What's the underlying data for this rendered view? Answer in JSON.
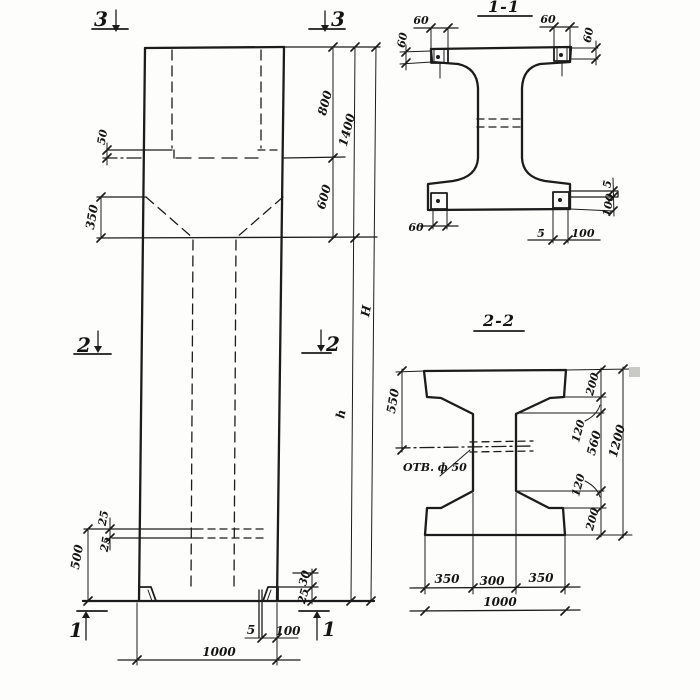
{
  "markers": {
    "section3": "3",
    "section2": "2",
    "section1": "1"
  },
  "elevation": {
    "dim_50": "50",
    "dim_350": "350",
    "dim_800": "800",
    "dim_1400": "1400",
    "dim_600": "600",
    "dim_H": "H",
    "dim_h": "h",
    "dim_25_top": "25",
    "dim_25_bottom": "25",
    "dim_500": "500",
    "dim_30_foot": "30",
    "dim_25_foot": "25",
    "dim_5_base": "5",
    "dim_100_base": "100",
    "dim_1000": "1000"
  },
  "section11": {
    "title": "1-1",
    "dim_60_top_left": "60",
    "dim_60_left": "60",
    "dim_60_top_right": "60",
    "dim_60_right": "60",
    "dim_60_bottom_left": "60",
    "dim_5_bottom": "5",
    "dim_100_bottom": "100",
    "dim_5_right": "5",
    "dim_100_right": "100"
  },
  "section22": {
    "title": "2-2",
    "dim_550": "550",
    "dim_200_top": "200",
    "dim_120_top": "120",
    "dim_560": "560",
    "dim_1200": "1200",
    "dim_120_bottom": "120",
    "dim_200_bottom": "200",
    "dim_350_left": "350",
    "dim_300": "300",
    "dim_350_right": "350",
    "dim_1000": "1000",
    "hole_label": "ОТВ. ф 50"
  }
}
